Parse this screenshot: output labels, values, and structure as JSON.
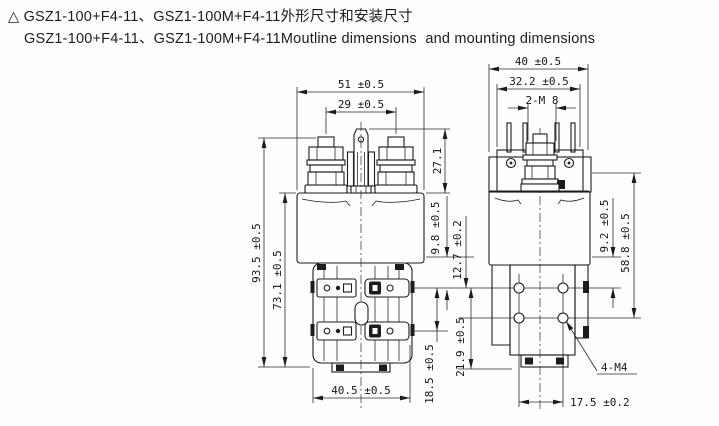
{
  "title": {
    "line1": "△ GSZ1-100+F4-11、GSZ1-100M+F4-11外形尺寸和安装尺寸",
    "line2": "GSZ1-100+F4-11、GSZ1-100M+F4-11Moutline dimensions  and mounting dimensions"
  },
  "dims": {
    "front": {
      "overall_width": "51 ±0.5",
      "terminal_spacing": "29 ±0.5",
      "terminal_height": "27.1",
      "overall_height": "93.5 ±0.5",
      "body_height": "73.1 ±0.5",
      "aux_offset": "9.8 ±0.5",
      "hole_offset": "12.7 ±0.2",
      "aux_spacing": "18.5 ±0.5",
      "hole_row_spacing": "21.9 ±0.5",
      "base_width": "40.5 ±0.5"
    },
    "side": {
      "overall_depth": "40 ±0.5",
      "flange_depth": "32.2 ±0.5",
      "main_terminal_thread": "2-M 8",
      "step_height": "9.2 ±0.5",
      "flange_height": "58.8 ±0.5",
      "mount_hole_thread": "4-M4",
      "hole_spacing": "17.5 ±0.2"
    }
  }
}
